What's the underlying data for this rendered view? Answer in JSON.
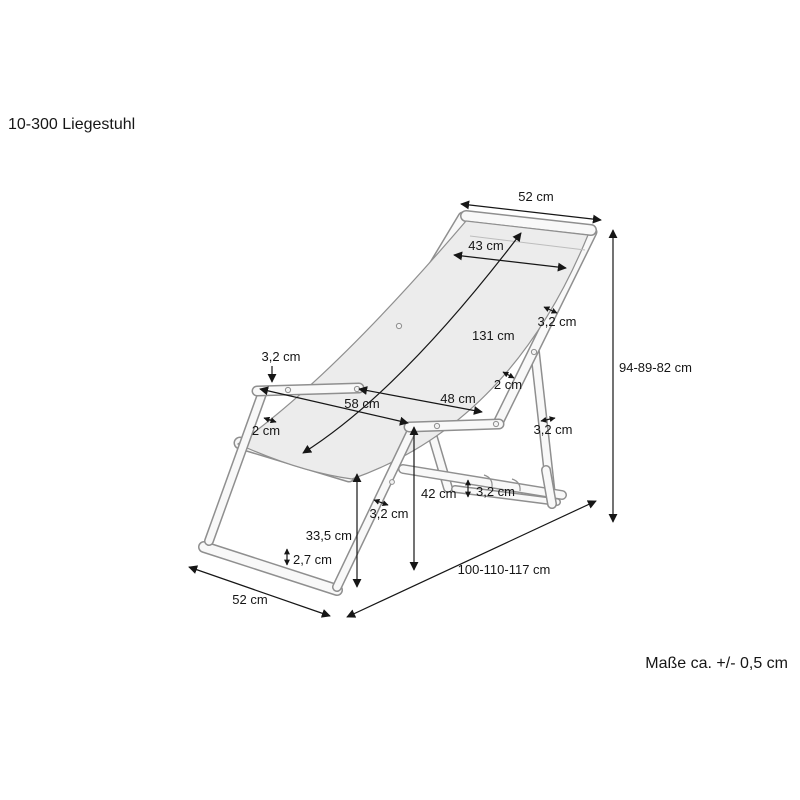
{
  "title": "10-300 Liegestuhl",
  "note": "Maße ca. +/- 0,5 cm",
  "product": "Liegestuhl (deck chair) dimension drawing",
  "colors": {
    "dimension_line": "#161616",
    "frame_outline": "#8f8f8f",
    "fabric_fill": "#ececec"
  },
  "dimensions": {
    "back_top_width": "52 cm",
    "fabric_width": "43 cm",
    "fabric_length": "131 cm",
    "height_range": "94-89-82 cm",
    "back_rail_thickness": "3,2 cm",
    "fabric_hem_right": "2 cm",
    "armrest_span_outer": "58 cm",
    "armrest_span_inner": "48 cm",
    "armrest_thickness": "3,2 cm",
    "fabric_hem_left": "2 cm",
    "rear_leg_thickness": "3,2 cm",
    "adjust_rail_thickness": "3,2 cm",
    "front_leg_thickness": "3,2 cm",
    "armrest_height": "42 cm",
    "seat_front_height": "33,5 cm",
    "base_rail_thickness": "2,7 cm",
    "base_width": "52 cm",
    "depth_range": "100-110-117 cm"
  }
}
